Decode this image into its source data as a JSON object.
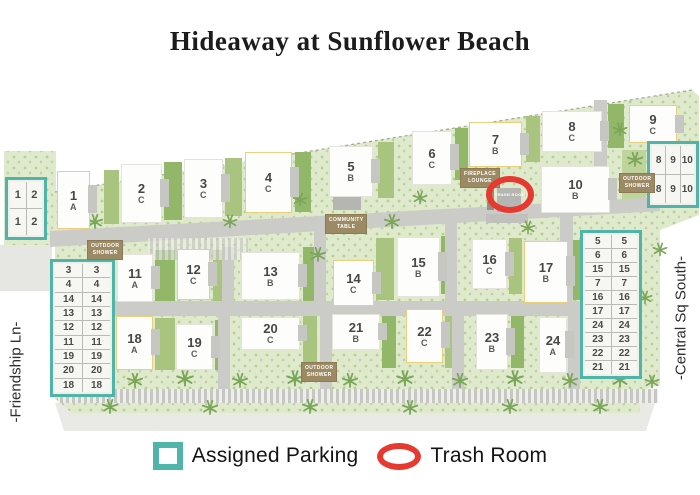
{
  "title": "Hideaway at Sunflower Beach",
  "streets": {
    "left": "-Friendship Ln-",
    "right": "-Central Sq South-"
  },
  "legend": {
    "parking": "Assigned Parking",
    "trash": "Trash Room"
  },
  "colors": {
    "teal": "#50b5a8",
    "red": "#e6392f",
    "yellow": "#eccf7d",
    "site_green": "#dfe9cc",
    "road": "#cbccc7",
    "hedge": "#a8c47f",
    "label_brown": "#9b8a64"
  },
  "buildings": [
    {
      "num": "1",
      "unit": "A",
      "x": 57,
      "y": 171,
      "w": 33,
      "h": 58,
      "outline": true
    },
    {
      "num": "2",
      "unit": "C",
      "x": 121,
      "y": 164,
      "w": 41,
      "h": 59,
      "outline": false
    },
    {
      "num": "3",
      "unit": "C",
      "x": 184,
      "y": 159,
      "w": 39,
      "h": 59,
      "outline": false
    },
    {
      "num": "4",
      "unit": "C",
      "x": 245,
      "y": 152,
      "w": 47,
      "h": 61,
      "outline": true
    },
    {
      "num": "5",
      "unit": "B",
      "x": 329,
      "y": 146,
      "w": 44,
      "h": 51,
      "outline": false
    },
    {
      "num": "6",
      "unit": "C",
      "x": 412,
      "y": 131,
      "w": 40,
      "h": 54,
      "outline": false
    },
    {
      "num": "7",
      "unit": "B",
      "x": 469,
      "y": 122,
      "w": 53,
      "h": 45,
      "outline": true
    },
    {
      "num": "8",
      "unit": "C",
      "x": 542,
      "y": 111,
      "w": 60,
      "h": 41,
      "outline": false
    },
    {
      "num": "9",
      "unit": "C",
      "x": 629,
      "y": 105,
      "w": 48,
      "h": 38,
      "outline": true
    },
    {
      "num": "10",
      "unit": "B",
      "x": 541,
      "y": 166,
      "w": 69,
      "h": 47,
      "outline": false
    },
    {
      "num": "11",
      "unit": "A",
      "x": 117,
      "y": 254,
      "w": 36,
      "h": 48,
      "outline": false
    },
    {
      "num": "12",
      "unit": "C",
      "x": 177,
      "y": 249,
      "w": 33,
      "h": 51,
      "outline": true
    },
    {
      "num": "13",
      "unit": "B",
      "x": 241,
      "y": 252,
      "w": 59,
      "h": 48,
      "outline": false
    },
    {
      "num": "14",
      "unit": "C",
      "x": 333,
      "y": 260,
      "w": 41,
      "h": 46,
      "outline": true
    },
    {
      "num": "15",
      "unit": "B",
      "x": 397,
      "y": 237,
      "w": 43,
      "h": 60,
      "outline": false
    },
    {
      "num": "16",
      "unit": "C",
      "x": 472,
      "y": 239,
      "w": 35,
      "h": 50,
      "outline": false
    },
    {
      "num": "17",
      "unit": "B",
      "x": 524,
      "y": 241,
      "w": 44,
      "h": 62,
      "outline": true
    },
    {
      "num": "18",
      "unit": "A",
      "x": 116,
      "y": 316,
      "w": 37,
      "h": 54,
      "outline": true
    },
    {
      "num": "19",
      "unit": "C",
      "x": 176,
      "y": 324,
      "w": 37,
      "h": 46,
      "outline": false
    },
    {
      "num": "20",
      "unit": "C",
      "x": 241,
      "y": 317,
      "w": 59,
      "h": 33,
      "outline": false
    },
    {
      "num": "21",
      "unit": "B",
      "x": 332,
      "y": 314,
      "w": 48,
      "h": 36,
      "outline": false
    },
    {
      "num": "22",
      "unit": "C",
      "x": 406,
      "y": 309,
      "w": 37,
      "h": 54,
      "outline": true
    },
    {
      "num": "23",
      "unit": "B",
      "x": 476,
      "y": 314,
      "w": 32,
      "h": 56,
      "outline": false
    },
    {
      "num": "24",
      "unit": "A",
      "x": 539,
      "y": 317,
      "w": 28,
      "h": 56,
      "outline": false
    }
  ],
  "parking_tables": [
    {
      "name": "parking-table-top-left",
      "x": 5,
      "y": 177,
      "w": 42,
      "h": 63,
      "cols": 2,
      "rows": [
        [
          "1",
          "2"
        ],
        [
          "1",
          "2"
        ]
      ]
    },
    {
      "name": "parking-table-left",
      "x": 50,
      "y": 259,
      "w": 65,
      "h": 138,
      "cols": 2,
      "rows": [
        [
          "3",
          "3"
        ],
        [
          "4",
          "4"
        ],
        [
          "14",
          "14"
        ],
        [
          "13",
          "13"
        ],
        [
          "12",
          "12"
        ],
        [
          "11",
          "11"
        ],
        [
          "19",
          "19"
        ],
        [
          "20",
          "20"
        ],
        [
          "18",
          "18"
        ]
      ]
    },
    {
      "name": "parking-table-top-right",
      "x": 647,
      "y": 141,
      "w": 52,
      "h": 67,
      "cols": 3,
      "rows": [
        [
          "8",
          "9",
          "10"
        ],
        [
          "8",
          "9",
          "10"
        ]
      ]
    },
    {
      "name": "parking-table-right",
      "x": 580,
      "y": 230,
      "w": 62,
      "h": 149,
      "cols": 2,
      "rows": [
        [
          "5",
          "5"
        ],
        [
          "6",
          "6"
        ],
        [
          "15",
          "15"
        ],
        [
          "7",
          "7"
        ],
        [
          "16",
          "16"
        ],
        [
          "17",
          "17"
        ],
        [
          "24",
          "24"
        ],
        [
          "23",
          "23"
        ],
        [
          "22",
          "22"
        ],
        [
          "21",
          "21"
        ]
      ]
    }
  ],
  "amenity_labels": [
    {
      "name": "outdoor-shower-left",
      "lines": [
        "OUTDOOR",
        "SHOWER"
      ],
      "x": 87,
      "y": 240
    },
    {
      "name": "outdoor-shower-right",
      "lines": [
        "OUTDOOR",
        "SHOWER"
      ],
      "x": 619,
      "y": 173
    },
    {
      "name": "outdoor-shower-bottom",
      "lines": [
        "OUTDOOR",
        "SHOWER"
      ],
      "x": 301,
      "y": 362
    },
    {
      "name": "community-table",
      "lines": [
        "COMMUNITY",
        "TABLE"
      ],
      "x": 325,
      "y": 214
    },
    {
      "name": "fireplace-lounge",
      "lines": [
        "FIREPLACE",
        "LOUNGE"
      ],
      "x": 460,
      "y": 168
    }
  ],
  "trash_room": {
    "label": "TRASH ROOM",
    "x": 486,
    "y": 176,
    "w": 48,
    "h": 37
  }
}
